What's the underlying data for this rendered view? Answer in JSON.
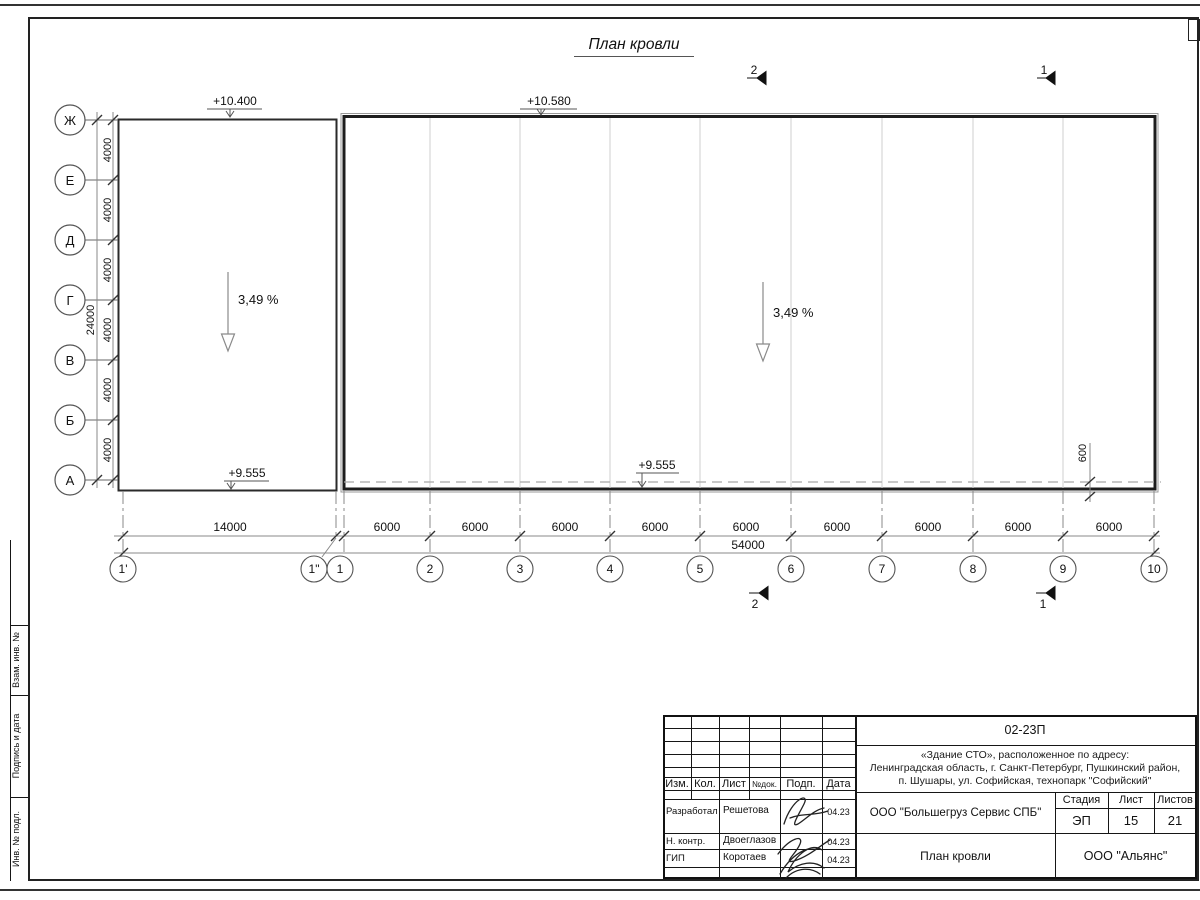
{
  "page": {
    "title": "План кровли"
  },
  "frame": {
    "side_labels": [
      "Взам. инв. №",
      "Подпись и дата",
      "Инв. № подл."
    ]
  },
  "drawing": {
    "row_axes": [
      "Ж",
      "Е",
      "Д",
      "Г",
      "В",
      "Б",
      "А"
    ],
    "col_axes": [
      "1'",
      "1\"",
      "1",
      "2",
      "3",
      "4",
      "5",
      "6",
      "7",
      "8",
      "9",
      "10"
    ],
    "dims": {
      "row_spacing": [
        "4000",
        "4000",
        "4000",
        "4000",
        "4000",
        "4000"
      ],
      "row_total": "24000",
      "col_first": "14000",
      "col_spacing": [
        "6000",
        "6000",
        "6000",
        "6000",
        "6000",
        "6000",
        "6000",
        "6000",
        "6000"
      ],
      "col_total": "54000",
      "offset": "600"
    },
    "elevations": {
      "top_left": "+10.400",
      "top_right": "+10.580",
      "bottom_left": "+9.555",
      "bottom_right": "+9.555"
    },
    "slope_left": "3,49 %",
    "slope_right": "3,49 %",
    "section_markers": {
      "top": [
        "2",
        "1"
      ],
      "bottom": [
        "2",
        "1"
      ]
    }
  },
  "title_block": {
    "doc_number": "02-23П",
    "project_lines": [
      "«Здание СТО», расположенное по адресу:",
      "Ленинградская область, г. Санкт-Петербург, Пушкинский район,",
      "п. Шушары, ул. Софийская, технопарк \"Софийский\""
    ],
    "header_cols": [
      "Изм.",
      "Кол.",
      "Лист",
      "№док.",
      "Подп.",
      "Дата"
    ],
    "rows": [
      {
        "role": "Разработал",
        "name": "Решетова",
        "date": "04.23"
      },
      {
        "role": "Н. контр.",
        "name": "Двоеглазов",
        "date": "04.23"
      },
      {
        "role": "ГИП",
        "name": "Коротаев",
        "date": "04.23"
      }
    ],
    "company": "ООО \"Большегруз Сервис СПБ\"",
    "stage_header": [
      "Стадия",
      "Лист",
      "Листов"
    ],
    "stage_values": [
      "ЭП",
      "15",
      "21"
    ],
    "sheet_title": "План кровли",
    "org": "ООО \"Альянс\""
  },
  "colors": {
    "line_dark": "#1d1d1d",
    "line_dim": "#8a8a8a",
    "text": "#111111"
  }
}
